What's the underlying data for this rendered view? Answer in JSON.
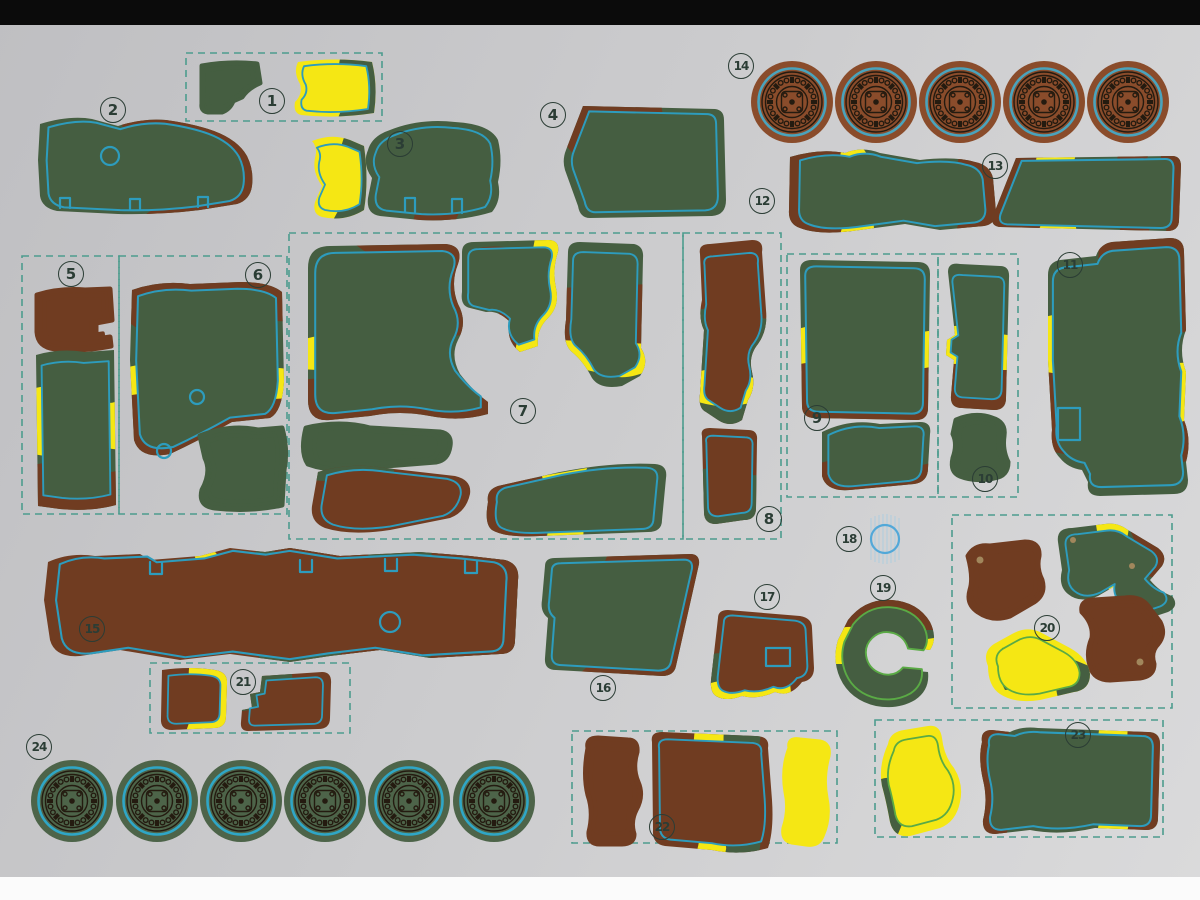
{
  "sheet_labels": {
    "pieces": [
      {
        "label": "1"
      },
      {
        "label": "2"
      },
      {
        "label": "3"
      },
      {
        "label": "4"
      },
      {
        "label": "5"
      },
      {
        "label": "6"
      },
      {
        "label": "7"
      },
      {
        "label": "8"
      },
      {
        "label": "9"
      },
      {
        "label": "10"
      },
      {
        "label": "11"
      },
      {
        "label": "12"
      },
      {
        "label": "13"
      },
      {
        "label": "14"
      },
      {
        "label": "15"
      },
      {
        "label": "16"
      },
      {
        "label": "17"
      },
      {
        "label": "18"
      },
      {
        "label": "19"
      },
      {
        "label": "20"
      },
      {
        "label": "21"
      },
      {
        "label": "22"
      },
      {
        "label": "23"
      },
      {
        "label": "24"
      }
    ]
  },
  "colors": {
    "bg_a": "#bfbfc2",
    "bg_b": "#dadadb",
    "bar_top": "#0b0b0b",
    "bar_bottom": "#fbfbfb",
    "green": "#455e41",
    "brown": "#703c21",
    "yellow": "#f5e714",
    "wheel_brown": "#8a4c2b",
    "wheel_green": "#4d6449",
    "wheel_detail": "#241b10",
    "ring_brown": "#4aa3bc",
    "ring_green": "#2fa6c6",
    "cut": "#2d9cbd",
    "cut_yellow": "#5aaa45",
    "dash": "#4d9c8e",
    "badge": "#2b3d35",
    "mesh": "#52a8d8",
    "mesh_hatch": "#b5cedd",
    "hole_dot": "#a1875c",
    "sheet_hole": "#c9c9cb"
  }
}
